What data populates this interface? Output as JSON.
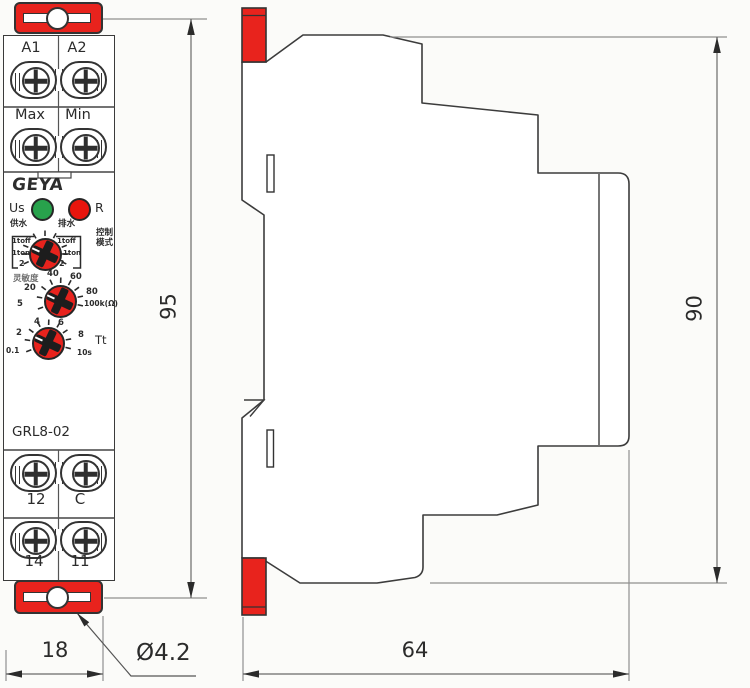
{
  "front": {
    "top_terminals": [
      "A1",
      "A2"
    ],
    "mid_terminals": [
      "Max",
      "Min"
    ],
    "brand": "GEYA",
    "led_left": "Us",
    "led_right": "R",
    "mode": {
      "left_heading": "供水",
      "right_heading": "排水",
      "side_line1": "控制",
      "side_line2": "模式",
      "left_options": [
        "1toff",
        "1ton",
        "2"
      ],
      "right_options": [
        "1toff",
        "1ton",
        "2"
      ]
    },
    "sensitivity": {
      "heading": "灵敏度",
      "ticks": [
        "5",
        "20",
        "40",
        "60",
        "80"
      ],
      "unit": "100k(Ω)"
    },
    "timer": {
      "ticks": [
        "0.1",
        "2",
        "4",
        "6",
        "8",
        "10s"
      ],
      "label": "Tt"
    },
    "model": "GRL8-02",
    "out_row1": [
      "12",
      "C"
    ],
    "out_row2": [
      "14",
      "11"
    ]
  },
  "dims": {
    "front_height": "95",
    "side_height": "90",
    "front_width": "18",
    "side_depth": "64",
    "hole": "Ø4.2"
  },
  "colors": {
    "accent_red": "#e8231d",
    "led_green": "#28a24c",
    "led_red": "#e8150d",
    "outline": "#3a3a3a",
    "dim_line": "#8f8f8f",
    "text": "#2b2b2b"
  }
}
